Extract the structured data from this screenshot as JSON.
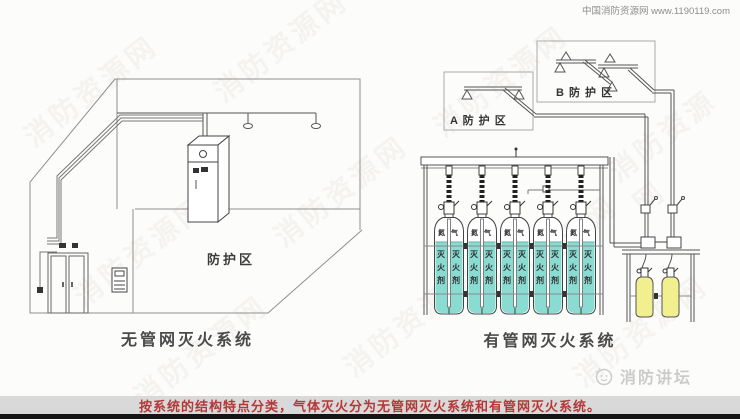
{
  "header": {
    "credit": "中国消防资源网 www.1190119.com"
  },
  "left_system": {
    "zone_label": "防护区",
    "caption": "无管网灭火系统"
  },
  "right_system": {
    "zone_a_label": "A 防 护 区",
    "zone_b_label": "B 防 护 区",
    "nitrogen_label": "氮气",
    "agent_label": "灭火剂",
    "caption": "有管网灭火系统"
  },
  "footer": {
    "text": "按系统的结构特点分类，气体灭火分为无管网灭火系统和有管网灭火系统。"
  },
  "branding": {
    "forum_logo_text": "消防讲坛",
    "watermark_text": "消防资源网"
  },
  "colors": {
    "agent_liquid": "#8ADCD2",
    "pilot_cylinder": "#F2EF8F",
    "footer_bar": "#D9D9D9",
    "footer_text": "#B43838",
    "diagram_line": "#555555"
  }
}
